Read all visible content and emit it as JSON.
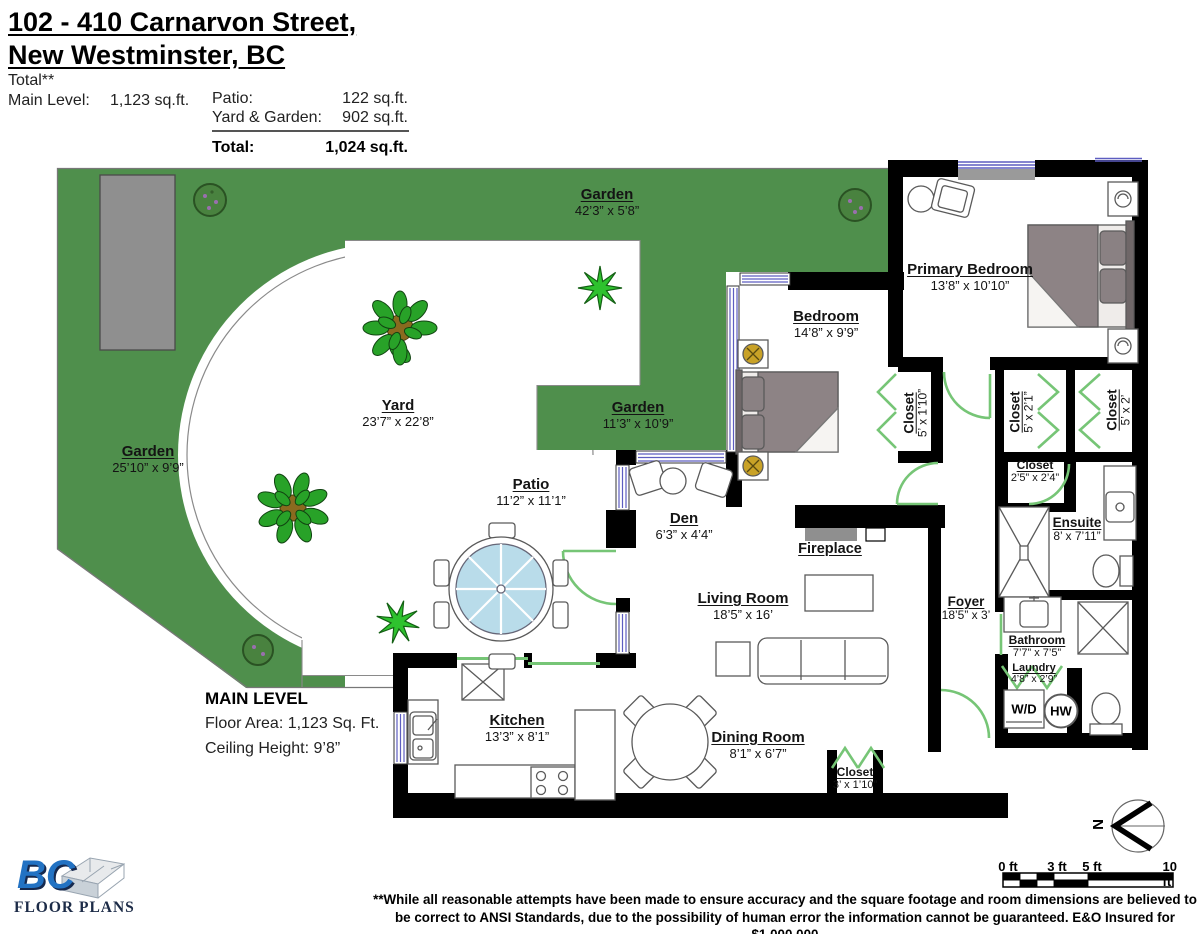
{
  "header": {
    "title_line1": "102 - 410 Carnarvon Street,",
    "title_line2": "New Westminster, BC",
    "total_note": "Total**",
    "main_level_label": "Main Level:",
    "main_level_value": "1,123 sq.ft.",
    "patio_label": "Patio:",
    "patio_value": "122 sq.ft.",
    "yard_garden_label": "Yard & Garden:",
    "yard_garden_value": "902 sq.ft.",
    "total_label": "Total:",
    "total_value": "1,024 sq.ft."
  },
  "rooms": {
    "garden_top": {
      "name": "Garden",
      "dims": "42’3” x 5’8”"
    },
    "garden_left": {
      "name": "Garden",
      "dims": "25’10” x 9’9”"
    },
    "garden_mid": {
      "name": "Garden",
      "dims": "11’3” x 10’9”"
    },
    "yard": {
      "name": "Yard",
      "dims": "23’7” x 22’8”"
    },
    "patio": {
      "name": "Patio",
      "dims": "11’2” x 11’1”"
    },
    "primary_bedroom": {
      "name": "Primary Bedroom",
      "dims": "13’8” x 10’10”"
    },
    "bedroom": {
      "name": "Bedroom",
      "dims": "14’8” x 9’9”"
    },
    "closet_bedroom": {
      "name": "Closet",
      "dims": "5’ x 1’10”"
    },
    "closet_a": {
      "name": "Closet",
      "dims": "5’ x 2’1”"
    },
    "closet_b": {
      "name": "Closet",
      "dims": "5’ x 2’"
    },
    "closet_hall": {
      "name": "Closet",
      "dims": "2’5” x 2’4”"
    },
    "ensuite": {
      "name": "Ensuite",
      "dims": "8’ x 7’11”"
    },
    "bathroom": {
      "name": "Bathroom",
      "dims": "7’7” x 7’5”"
    },
    "laundry": {
      "name": "Laundry",
      "dims": "4’8” x 2’9”"
    },
    "foyer": {
      "name": "Foyer",
      "dims": "18’5” x 3’"
    },
    "den": {
      "name": "Den",
      "dims": "6’3” x 4’4”"
    },
    "living_room": {
      "name": "Living Room",
      "dims": "18’5” x 16’"
    },
    "dining_room": {
      "name": "Dining Room",
      "dims": "8’1” x 6’7”"
    },
    "kitchen": {
      "name": "Kitchen",
      "dims": "13’3” x 8’1”"
    },
    "closet_entry": {
      "name": "Closet",
      "dims": "3’ x 1’10”"
    },
    "fireplace": {
      "name": "Fireplace"
    }
  },
  "appliances": {
    "washer_dryer": "W/D",
    "hot_water": "HW"
  },
  "main_level_block": {
    "title": "MAIN LEVEL",
    "floor_area": "Floor Area: 1,123 Sq. Ft.",
    "ceiling_height": "Ceiling Height: 9’8”"
  },
  "compass": {
    "north": "N"
  },
  "scale_bar": {
    "labels": [
      "0 ft",
      "3 ft",
      "5 ft",
      "10 ft"
    ]
  },
  "footer": {
    "line1": "**While all reasonable attempts have been made to ensure accuracy and the square footage and room dimensions are believed to",
    "line2": "be correct to ANSI Standards, due to the possibility of human error the information cannot be guaranteed. E&O Insured for $1,000,000"
  },
  "logo": {
    "bc": "BC",
    "floor_plans": "FLOOR PLANS"
  },
  "colors": {
    "garden_green": "#4f8f4c",
    "door_green": "#76c576",
    "window_blue": "#5d5dc0",
    "wall_black": "#000000",
    "furniture_gray": "#8d8385",
    "umbrella_blue": "#b9dcea",
    "planter_gray": "#8f8f8f",
    "logo_blue": "#2272c3"
  }
}
